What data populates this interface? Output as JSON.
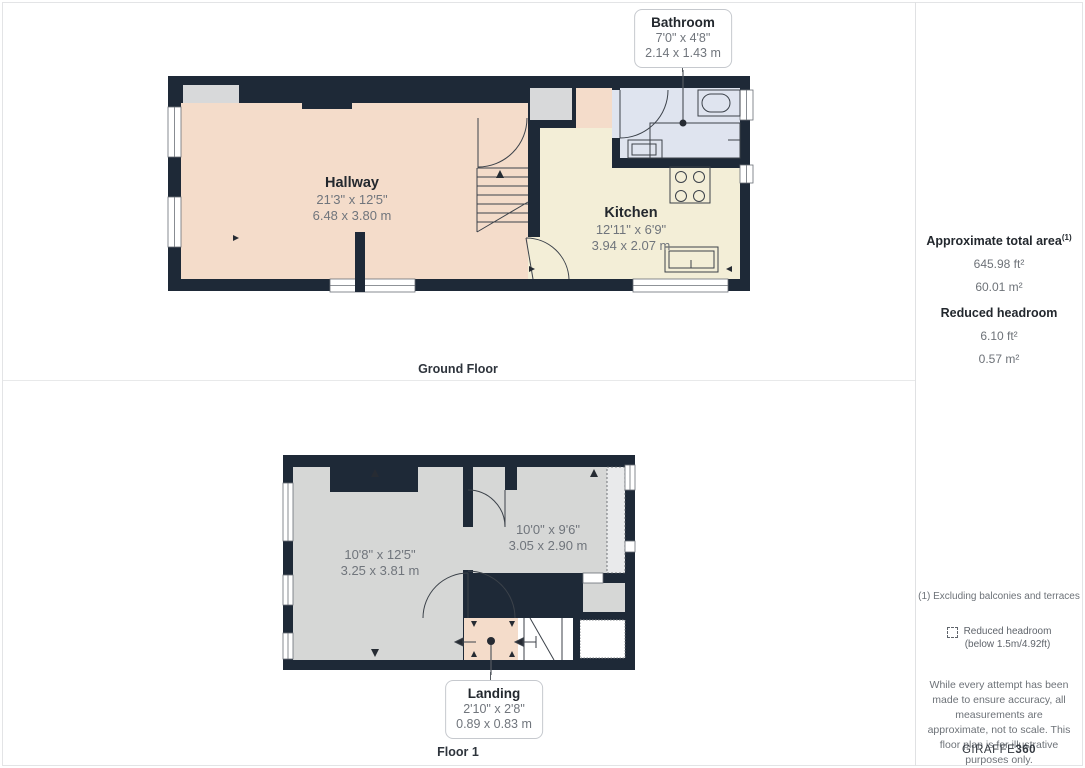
{
  "floors": [
    {
      "label": "Ground Floor",
      "rooms": [
        {
          "name": "Hallway",
          "imperial": "21'3\" x 12'5\"",
          "metric": "6.48 x 3.80 m"
        },
        {
          "name": "Kitchen",
          "imperial": "12'11\" x 6'9\"",
          "metric": "3.94 x 2.07 m"
        }
      ],
      "callout": {
        "name": "Bathroom",
        "imperial": "7'0\" x 4'8\"",
        "metric": "2.14 x 1.43 m"
      }
    },
    {
      "label": "Floor 1",
      "rooms": [
        {
          "imperial": "10'8\" x 12'5\"",
          "metric": "3.25 x 3.81 m"
        },
        {
          "imperial": "10'0\" x 9'6\"",
          "metric": "3.05 x 2.90 m"
        }
      ],
      "callout": {
        "name": "Landing",
        "imperial": "2'10\" x 2'8\"",
        "metric": "0.89 x 0.83 m"
      }
    }
  ],
  "sidebar": {
    "total_area": {
      "title": "Approximate total area",
      "superscript": "(1)",
      "imperial": "645.98 ft²",
      "metric": "60.01 m²"
    },
    "reduced_headroom": {
      "title": "Reduced headroom",
      "imperial": "6.10 ft²",
      "metric": "0.57 m²"
    },
    "footnote": "(1) Excluding balconies and terraces",
    "legend": {
      "line1": "Reduced headroom",
      "line2": "(below 1.5m/4.92ft)"
    },
    "disclaimer": "While every attempt has been made to ensure accuracy, all measurements are approximate, not to scale. This floor plan is for illustrative purposes only.",
    "brand": {
      "name": "GIRAFFE",
      "suffix": "360"
    }
  },
  "colors": {
    "wall": "#1e2937",
    "hallway_pink": "#f4dcca",
    "kitchen_cream": "#f3eed7",
    "bathroom_blue": "#dfe4ef",
    "room_gray": "#d6d7d6",
    "line_dark": "#3c424a"
  }
}
